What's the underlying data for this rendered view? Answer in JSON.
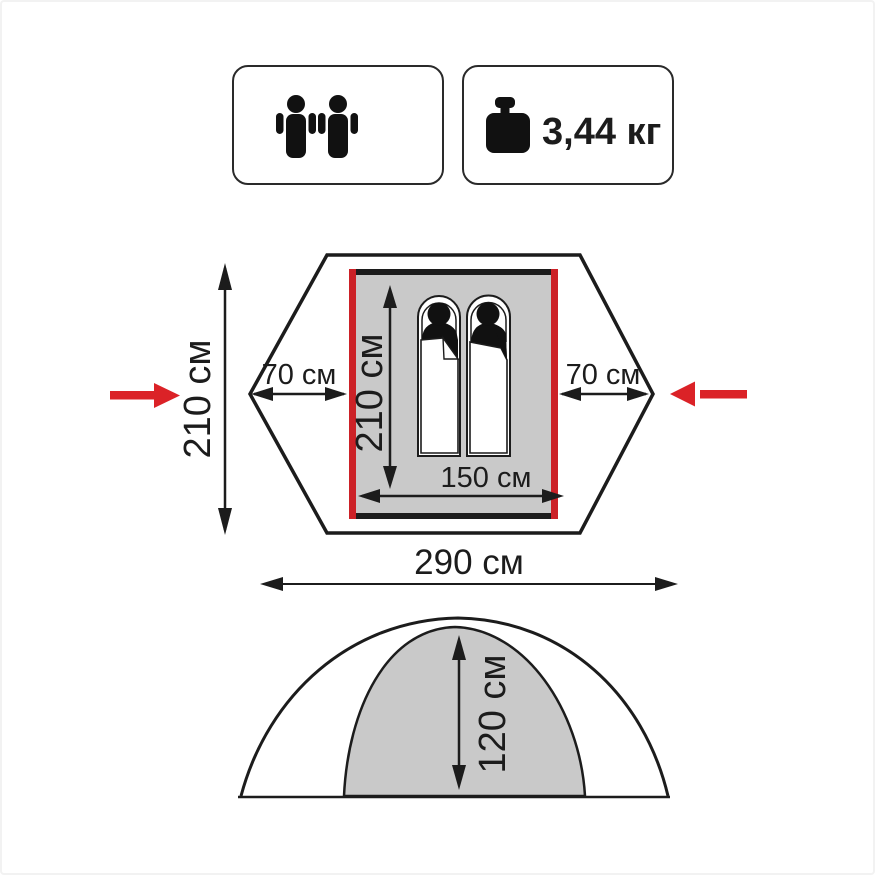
{
  "badges": {
    "capacity": {
      "persons": 2
    },
    "weight": {
      "value": "3,44 кг"
    }
  },
  "floor_plan": {
    "outer_height": "210 см",
    "left_vestibule_width": "70 см",
    "right_vestibule_width": "70 см",
    "inner_length": "210 см",
    "inner_width": "150 см",
    "total_width": "290 см"
  },
  "side_profile": {
    "inner_height": "120 см"
  },
  "colors": {
    "outline": "#1c1c1c",
    "floor_fill": "#c9c9c9",
    "dome_fill": "#c9c9c9",
    "frame_red": "#cc2127",
    "arrow_red": "#db2227"
  }
}
